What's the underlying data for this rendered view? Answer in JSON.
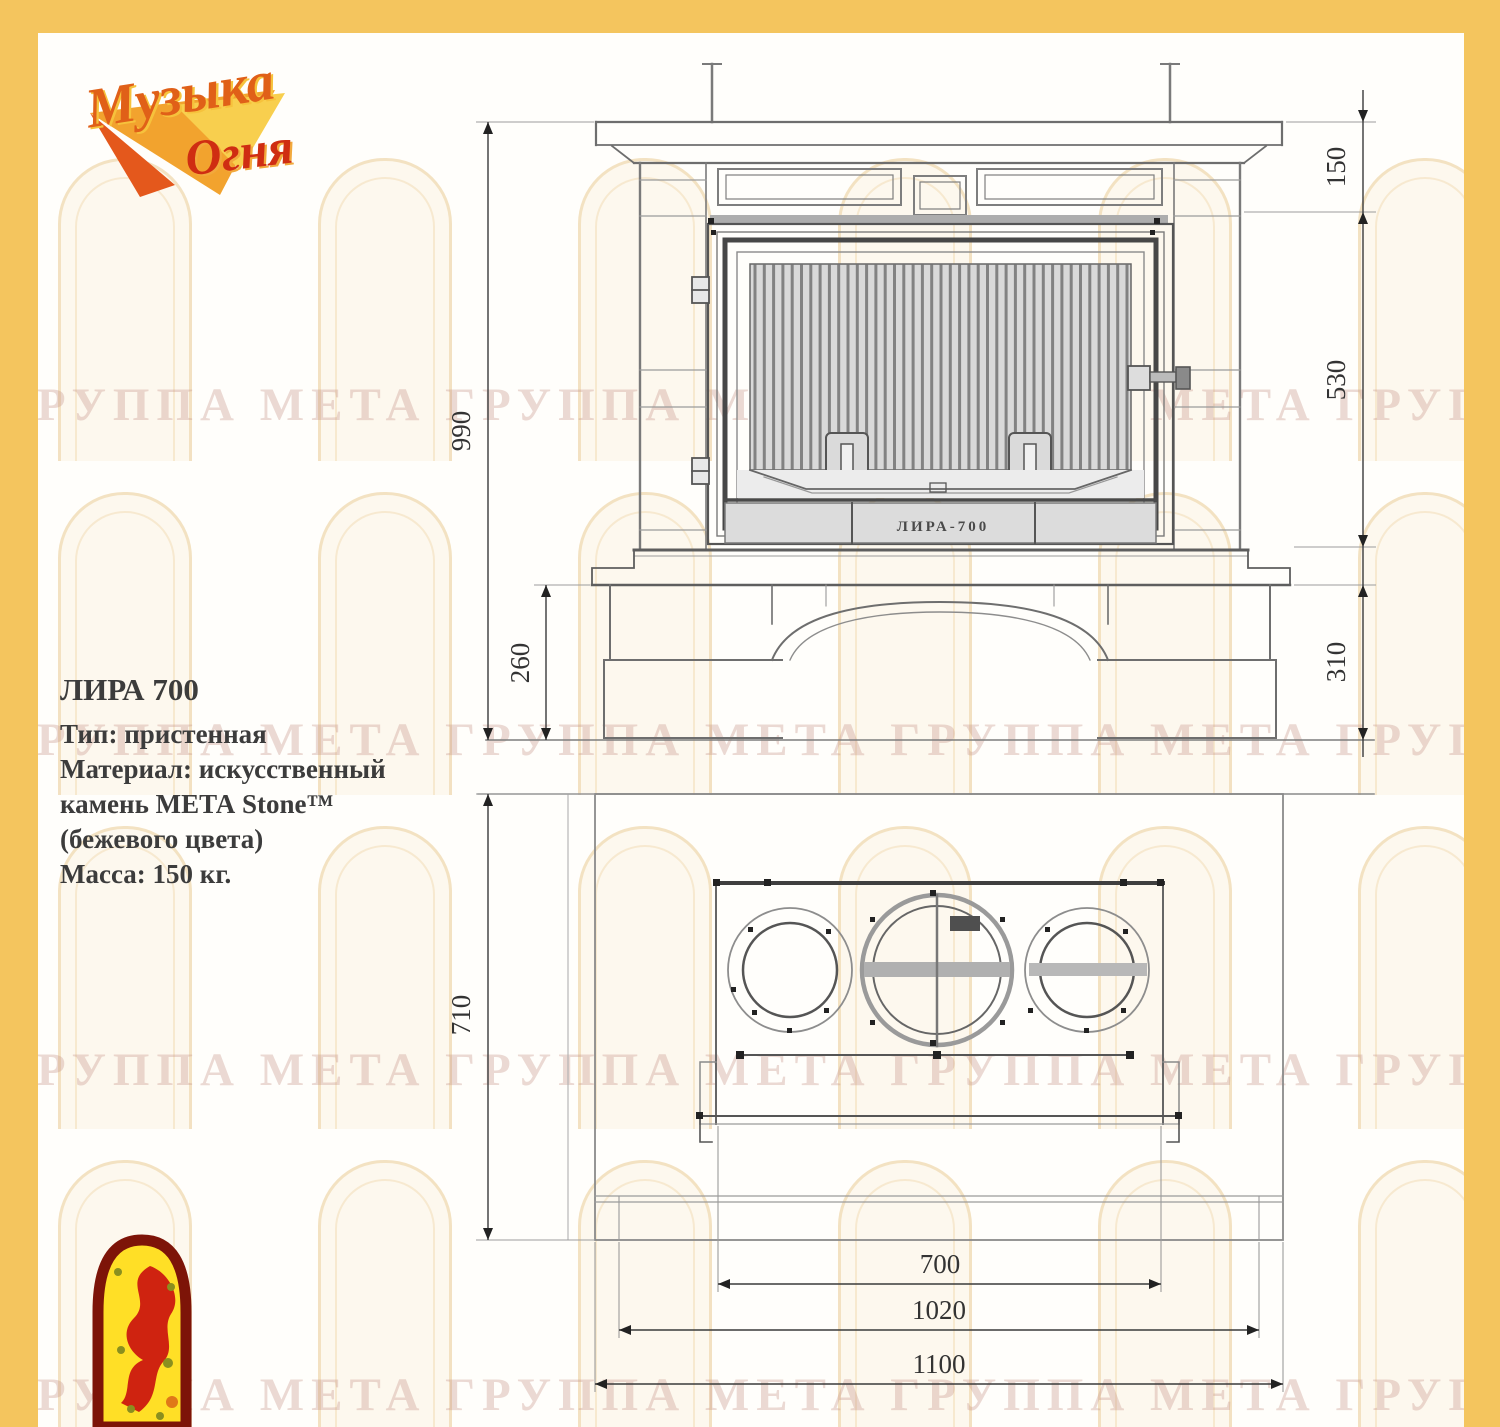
{
  "page": {
    "border_color": "#f4c55e",
    "background": "#fffefb"
  },
  "brand": {
    "logo_word1": "Музыка",
    "logo_word2": "Огня"
  },
  "product": {
    "name": "ЛИРА 700",
    "type_line": "Тип: пристенная",
    "material_line1": "Материал: искусственный",
    "material_line2": "камень МЕТА Stone™",
    "material_line3": "(бежевого  цвета)",
    "mass_line": "Масса: 150 кг."
  },
  "front_view": {
    "dims": {
      "crown_height": "150",
      "firebox_height": "530",
      "base_height": "310",
      "total_height": "990",
      "pedestal_height": "260"
    },
    "door_stamp": "ЛИРА-700"
  },
  "plan_view": {
    "dims": {
      "depth": "710",
      "insert_width": "700",
      "hearth_width": "1020",
      "total_width": "1100"
    }
  },
  "watermark": {
    "text": "ГРУППА МЕТА ГРУППА МЕТА ГРУППА МЕТА ГРУППА МЕТА ГРУППА МЕТА"
  }
}
